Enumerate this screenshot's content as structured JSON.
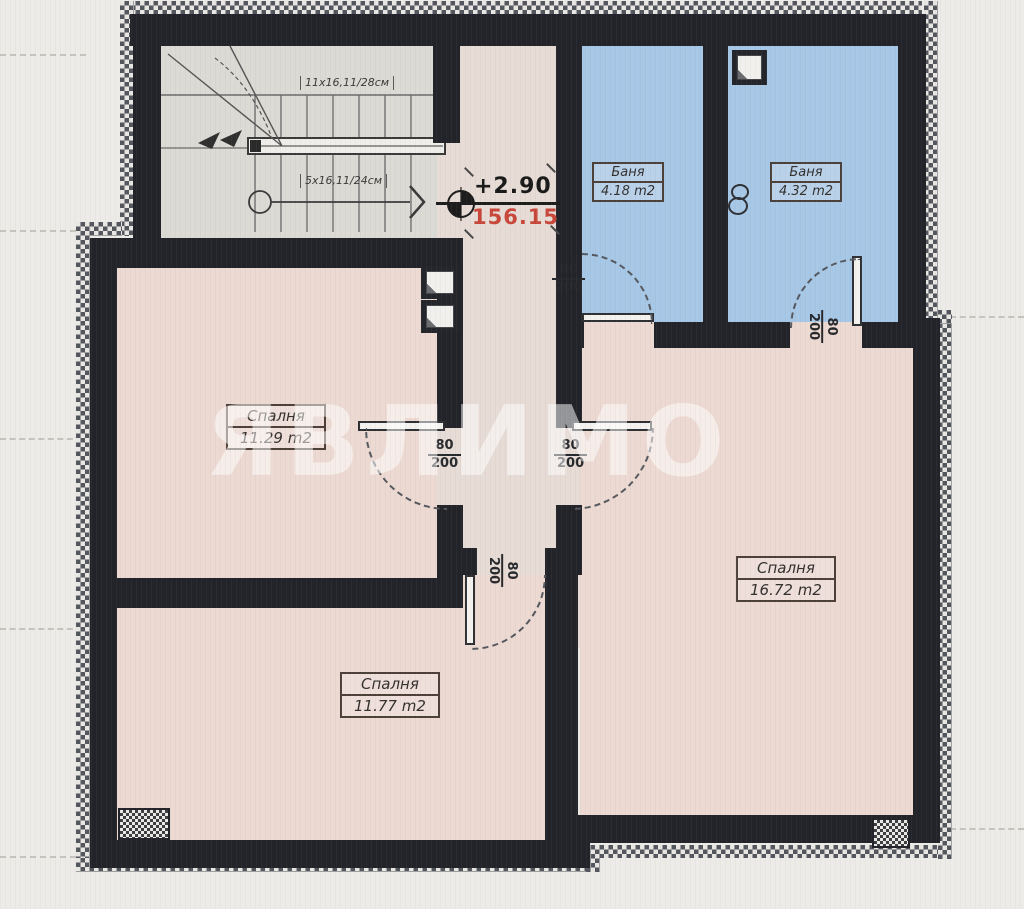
{
  "plan": {
    "watermark": "ЯВЛИМО",
    "elevation": {
      "level": "+2.90",
      "altitude": "156.15"
    },
    "stairs": {
      "upper_flight_label": "11x16,11/28см",
      "lower_flight_label": "5x16,11/24см"
    },
    "door_size": {
      "width": "80",
      "height": "200"
    },
    "rooms": {
      "bedroom_left": {
        "name": "Спалня",
        "area": "11.29 m2"
      },
      "bedroom_bottom": {
        "name": "Спалня",
        "area": "11.77 m2"
      },
      "bedroom_right": {
        "name": "Спалня",
        "area": "16.72 m2"
      },
      "bathroom_left": {
        "name": "Баня",
        "area": "4.18 m2"
      },
      "bathroom_right": {
        "name": "Баня",
        "area": "4.32 m2"
      }
    },
    "colors": {
      "bedroom_fill": "#ecd9d2",
      "bathroom_fill": "#a7c7e6",
      "hall_fill": "#e6dcd5",
      "stair_fill": "#dcdad5",
      "wall": "#22242a",
      "altitude_red": "#c8473a"
    }
  }
}
